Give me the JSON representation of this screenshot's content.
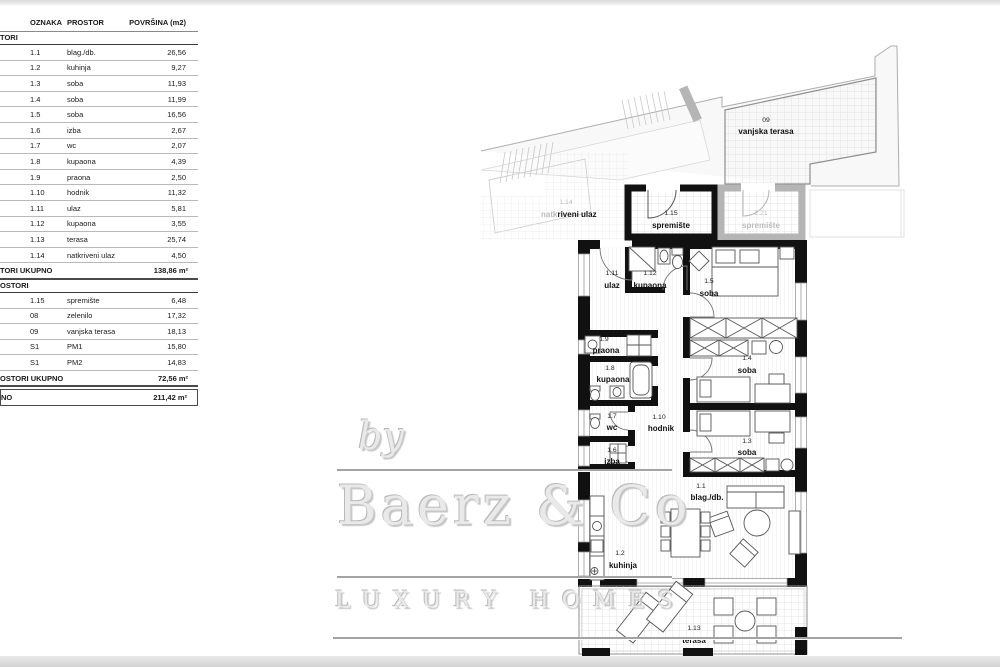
{
  "table": {
    "header": {
      "col1": "OZNAKA",
      "col2": "PROSTOR",
      "col3": "POVRŠINA (m2)"
    },
    "section1": {
      "label": "TORI"
    },
    "rows1": [
      {
        "oznaka": "1.1",
        "prostor": "blag./db.",
        "povrsina": "26,56"
      },
      {
        "oznaka": "1.2",
        "prostor": "kuhinja",
        "povrsina": "9,27"
      },
      {
        "oznaka": "1.3",
        "prostor": "soba",
        "povrsina": "11,93"
      },
      {
        "oznaka": "1.4",
        "prostor": "soba",
        "povrsina": "11,99"
      },
      {
        "oznaka": "1.5",
        "prostor": "soba",
        "povrsina": "16,56"
      },
      {
        "oznaka": "1.6",
        "prostor": "izba",
        "povrsina": "2,67"
      },
      {
        "oznaka": "1.7",
        "prostor": "wc",
        "povrsina": "2,07"
      },
      {
        "oznaka": "1.8",
        "prostor": "kupaona",
        "povrsina": "4,39"
      },
      {
        "oznaka": "1.9",
        "prostor": "praona",
        "povrsina": "2,50"
      },
      {
        "oznaka": "1.10",
        "prostor": "hodnik",
        "povrsina": "11,32"
      },
      {
        "oznaka": "1.11",
        "prostor": "ulaz",
        "povrsina": "5,81"
      },
      {
        "oznaka": "1.12",
        "prostor": "kupaona",
        "povrsina": "3,55"
      },
      {
        "oznaka": "1.13",
        "prostor": "terasa",
        "povrsina": "25,74"
      },
      {
        "oznaka": "1.14",
        "prostor": "natkriveni ulaz",
        "povrsina": "4,50"
      }
    ],
    "total1": {
      "label": "TORI UKUPNO",
      "value": "138,86 m²"
    },
    "section2": {
      "label": "OSTORI"
    },
    "rows2": [
      {
        "oznaka": "1.15",
        "prostor": "spremište",
        "povrsina": "6,48"
      },
      {
        "oznaka": "08",
        "prostor": "zelenilo",
        "povrsina": "17,32"
      },
      {
        "oznaka": "09",
        "prostor": "vanjska terasa",
        "povrsina": "18,13"
      },
      {
        "oznaka": "S1",
        "prostor": "PM1",
        "povrsina": "15,80"
      },
      {
        "oznaka": "S1",
        "prostor": "PM2",
        "povrsina": "14,83"
      }
    ],
    "total2": {
      "label": "OSTORI UKUPNO",
      "value": "72,56 m²"
    },
    "grand": {
      "label": "NO",
      "value": "211,42 m²"
    }
  },
  "plan": {
    "rooms": {
      "vanjska_terasa": {
        "id": "09",
        "name": "vanjska terasa"
      },
      "natkriveni_ulaz": {
        "id": "1.14",
        "name_a": "natk",
        "name_b": "riveni ulaz"
      },
      "spremiste": {
        "id": "1.15",
        "name": "spremište"
      },
      "spremiste_susjed": {
        "id": "2.21",
        "name": "spremište"
      },
      "ulaz": {
        "id": "1.11",
        "name": "ulaz"
      },
      "kupaona_112": {
        "id": "1.12",
        "name": "kupaona"
      },
      "soba_15": {
        "id": "1.5",
        "name": "soba"
      },
      "praona": {
        "id": "1.9",
        "name": "praona"
      },
      "kupaona_18": {
        "id": "1.8",
        "name": "kupaona"
      },
      "soba_14": {
        "id": "1.4",
        "name": "soba"
      },
      "wc": {
        "id": "1.7",
        "name": "wc"
      },
      "hodnik": {
        "id": "1.10",
        "name": "hodnik"
      },
      "izba": {
        "id": "1.6",
        "name": "izba"
      },
      "soba_13": {
        "id": "1.3",
        "name": "soba"
      },
      "blag_db": {
        "id": "1.1",
        "name": "blag./db."
      },
      "kuhinja": {
        "id": "1.2",
        "name": "kuhinja"
      },
      "terasa": {
        "id": "1.13",
        "name": "terasa"
      }
    },
    "colors": {
      "wall": "#111111",
      "neighbor_wall": "#b5b5b5",
      "context_line": "#c4c4c4",
      "grid_line": "#dcdcdc",
      "label": "#1a1a1a",
      "label_gray": "#bcbcbc"
    }
  },
  "watermark": {
    "by": "by",
    "brand": "Baerz & Co",
    "tagline": "LUXURY HOMES"
  }
}
